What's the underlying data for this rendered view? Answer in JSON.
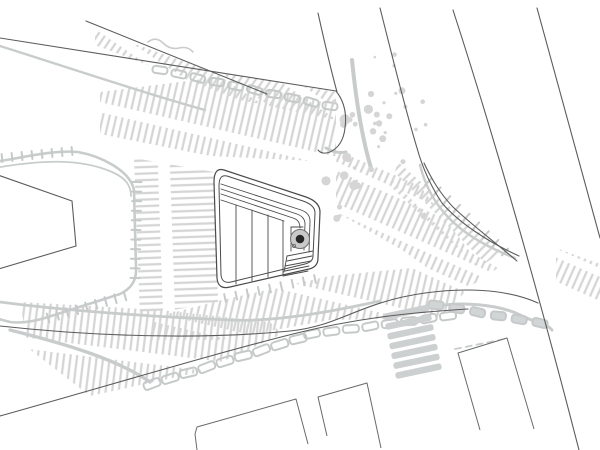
{
  "meta": {
    "kind": "architectural-site-plan",
    "description": "hand-drawn style urban site plan: streets converging on a plaza with striped paving and a tree symbol"
  },
  "palette": {
    "paper": "#ffffff",
    "hatch": "#d5d5d5",
    "sketch": "#c9cccc",
    "stone": "#c6c9c9",
    "dark": "#5c5c5c",
    "darker": "#4a4a4a",
    "tree_ring_fill": "#c9c9c9",
    "tree_ring_stroke": "#6e6e6e",
    "tree_core": "#272727"
  },
  "drawing": {
    "hatches": [
      {
        "name": "hatch-upper-road-median",
        "points": "95,30 211,71 336,92 336,120 240,100 95,45",
        "angle": 34,
        "dash": "26 9"
      },
      {
        "name": "hatch-upper-sidewalk",
        "points": "100,92 211,78 336,96 336,162 210,156 100,134",
        "angle": 13,
        "dash": "34 10"
      },
      {
        "name": "hatch-rows-west-of-plaza",
        "points": "134,158 214,172 218,302 140,316",
        "angle": 88,
        "dash": "46 12"
      },
      {
        "name": "hatch-south-of-plaza",
        "points": "152,318 222,300 330,276 412,268 465,292 440,318 330,320 220,340 152,340",
        "angle": 13,
        "dash": "36 9"
      },
      {
        "name": "hatch-east-of-plaza",
        "points": "336,150 420,186 470,252 498,268 462,292 402,250 336,212",
        "angle": 24,
        "dash": "30 8"
      },
      {
        "name": "hatch-junction-north",
        "points": "398,162 502,252 478,268 390,186",
        "angle": 45,
        "dash": "24 7"
      },
      {
        "name": "hatch-lower-road",
        "points": "20,302 160,310 270,322 282,334 200,372 90,396 28,348",
        "angle": 7,
        "dash": "40 11"
      },
      {
        "name": "hatch-east-of-road",
        "points": "556,248 600,264 600,302 556,286",
        "angle": 24,
        "dash": "22 8"
      }
    ],
    "sketches": [
      {
        "name": "sketch-block-outline",
        "d": "M -5,162 C 30,156 55,150 78,152 C 100,156 130,170 134,190 L 136,268 Q 137,286 120,294 L 45,318 Q 25,324 10,322 L -5,318",
        "w": 2.6
      },
      {
        "name": "sketch-block-outline-2",
        "d": "M -5,168 C 40,160 80,158 112,172 C 126,178 131,186 131,196",
        "w": 1.8
      },
      {
        "name": "sketch-upper-road-squiggle",
        "d": "M 148,42 q 8,-6 15,1 t 16,5 t 14,4",
        "w": 1.6
      },
      {
        "name": "sketch-upper-shadow",
        "d": "M 0,46 C 70,68 140,92 205,110",
        "w": 2.4
      },
      {
        "name": "sketch-v1-band",
        "d": "M 352,60 C 356,100 362,138 371,168",
        "w": 4
      },
      {
        "name": "sketch-junction-curve",
        "d": "M 420,165 C 430,205 455,235 515,258",
        "w": 2.4
      },
      {
        "name": "sketch-north-curb",
        "d": "M 0,302 C 60,310 140,316 230,320 C 275,322 330,312 380,301",
        "w": 2.8
      },
      {
        "name": "sketch-south-meander",
        "d": "M 428,308 C 460,300 500,305 520,315 S 545,322 552,330",
        "w": 3
      },
      {
        "name": "sketch-block-to-road",
        "d": "M 10,330 C 70,345 118,360 150,382",
        "w": 3.4
      },
      {
        "name": "sketch-b3-dash",
        "d": "M 455,349 L 505,339",
        "w": 1.8,
        "dash": "6 5"
      },
      {
        "name": "sketch-cap-blob",
        "d": "M 326,148 q 10,6 20,4",
        "w": 3
      }
    ],
    "tick_rows": [
      {
        "name": "curb-ticks-block-right",
        "x1": 137,
        "y1": 182,
        "x2": 135,
        "y2": 278,
        "n": 11,
        "len": 9
      },
      {
        "name": "curb-ticks-block-bottom",
        "x1": 125,
        "y1": 296,
        "x2": 48,
        "y2": 318,
        "n": 9,
        "len": 9
      },
      {
        "name": "curb-ticks-block-top",
        "x1": 2,
        "y1": 158,
        "x2": 72,
        "y2": 151,
        "n": 8,
        "len": 8
      },
      {
        "name": "curb-ticks-junction",
        "x1": 428,
        "y1": 182,
        "x2": 505,
        "y2": 252,
        "n": 9,
        "len": 9
      },
      {
        "name": "curb-ticks-plaza-south",
        "x1": 225,
        "y1": 298,
        "x2": 315,
        "y2": 279,
        "n": 9,
        "len": 8
      }
    ],
    "stone_chains": [
      {
        "name": "stones-upper-sidewalk",
        "x1": 160,
        "y1": 70,
        "x2": 330,
        "y2": 106,
        "n": 10,
        "w": 15,
        "h": 7,
        "fill": "none"
      },
      {
        "name": "stones-lower-south-a",
        "x1": 152,
        "y1": 384,
        "x2": 298,
        "y2": 339,
        "n": 9,
        "w": 17,
        "h": 8,
        "fill": "none"
      },
      {
        "name": "stones-lower-south-b",
        "x1": 312,
        "y1": 334,
        "x2": 448,
        "y2": 316,
        "n": 8,
        "w": 16,
        "h": 7.5,
        "fill": "none"
      },
      {
        "name": "stones-junction-row",
        "x1": 436,
        "y1": 305,
        "x2": 540,
        "y2": 323,
        "n": 6,
        "w": 15,
        "h": 8,
        "fill": "#d2d5d5"
      }
    ],
    "crosswalk": {
      "name": "crosswalk",
      "x": 383,
      "y": 309,
      "w": 47,
      "h": 6.5,
      "n": 7,
      "gap": 9.8,
      "dx": 2,
      "angle": -12
    },
    "speckles": [
      {
        "name": "gravel-speckles-main",
        "seed": 7,
        "x": 332,
        "y": 40,
        "w": 95,
        "h": 190,
        "n": 30,
        "rmin": 1.2,
        "rmax": 3.6
      },
      {
        "name": "gravel-speckles-dense",
        "seed": 3,
        "x": 325,
        "y": 100,
        "w": 60,
        "h": 90,
        "n": 10,
        "rmin": 2.2,
        "rmax": 5.5
      }
    ],
    "road_lines": [
      {
        "name": "road-line-diagonal-upper",
        "d": "M 86,21 L 267,94"
      },
      {
        "name": "road-line-diagonal-lower",
        "d": "M 0,38 L 336,91"
      },
      {
        "name": "road-line-end-cap",
        "d": "M 336,91 Q 348,106 345,128 Q 343,146 330,152 Q 322,155 318,150"
      },
      {
        "name": "road-line-v0",
        "d": "M 318,13 C 324,40 331,70 337,92"
      },
      {
        "name": "road-line-v1",
        "d": "M 380,8 C 392,55 404,105 417,148 C 422,166 430,185 442,203 C 458,222 488,242 519,256"
      },
      {
        "name": "road-line-v1-inner",
        "d": "M 424,163 C 432,180 440,193 452,206 C 466,220 492,240 517,261"
      },
      {
        "name": "road-line-v2",
        "d": "M 453,10 C 488,118 530,260 579,450"
      },
      {
        "name": "road-line-v3",
        "d": "M 537,8 C 557,82 578,160 600,238"
      },
      {
        "name": "road-line-north-curb",
        "d": "M 0,326 C 90,336 200,340 290,331 C 340,326 360,302 425,293 C 460,288 505,288 538,303"
      },
      {
        "name": "road-line-south-curb",
        "d": "M 0,416 C 100,388 220,352 297,333 C 350,320 400,313 468,309"
      },
      {
        "name": "block-inner-edge",
        "d": "M -5,174 L 72,201 L 76,246 L -5,270"
      }
    ],
    "buildings": [
      {
        "name": "building-southwest",
        "d": "M 197,450 L 195,434 L 197,427 L 296,399 L 308,444"
      },
      {
        "name": "building-south-mid",
        "d": "M 327,436 L 318,397 L 367,383 L 381,448"
      },
      {
        "name": "building-southeast",
        "d": "M 480,430 L 458,353 L 507,338 L 534,429"
      }
    ],
    "plaza": {
      "outline_outer": "M 224,170 L 306,197 Q 320,202 320,212 L 318,258 Q 318,267 309,269 L 230,287 Q 218,290 217,278 L 214,182 Q 214,167 224,170 Z",
      "outline_inner": "M 227,176 L 303,201 Q 315,205 315,213 L 313,256 Q 313,262 305,264 L 231,282 Q 222,284 221,275 L 219,186 Q 219,174 227,176 Z",
      "stripes": [
        {
          "name": "plaza-stripe-top-1",
          "d": "M 221,184 L 301,210 Q 310,213 310,221 L 309,252"
        },
        {
          "name": "plaza-stripe-top-2",
          "d": "M 221,189 L 297,214 Q 305,217 305,224 L 304,250"
        },
        {
          "name": "plaza-stripe-top-3",
          "d": "M 221,194 L 293,218 Q 300,220 300,228"
        },
        {
          "name": "plaza-stripe-hanger",
          "d": "M 221,200 L 284,221"
        },
        {
          "name": "plaza-stripe-vert-1",
          "d": "M 236,205 L 236,284"
        },
        {
          "name": "plaza-stripe-vert-2",
          "d": "M 252,210 L 252,281"
        },
        {
          "name": "plaza-stripe-vert-3",
          "d": "M 268,215 L 268,277"
        },
        {
          "name": "plaza-stripe-vert-4",
          "d": "M 283,221 L 283,274"
        },
        {
          "name": "plaza-alcove-top",
          "d": "M 291,227 L 303,227"
        },
        {
          "name": "plaza-alcove-left",
          "d": "M 291,227 L 291,251"
        },
        {
          "name": "plaza-nest-1",
          "d": "M 287,256 L 313,251"
        },
        {
          "name": "plaza-nest-2",
          "d": "M 287,261 L 312,256"
        },
        {
          "name": "plaza-nest-3",
          "d": "M 285,266 L 311,261"
        },
        {
          "name": "plaza-nest-4",
          "d": "M 285,271 L 309,266"
        },
        {
          "name": "plaza-nest-5",
          "d": "M 283,276 L 308,271"
        },
        {
          "name": "plaza-nest-connector",
          "d": "M 287,256 L 284,272"
        }
      ]
    },
    "tree": {
      "cx": 300,
      "cy": 239,
      "r_ring": 9.5,
      "r_core": 4.3
    }
  }
}
